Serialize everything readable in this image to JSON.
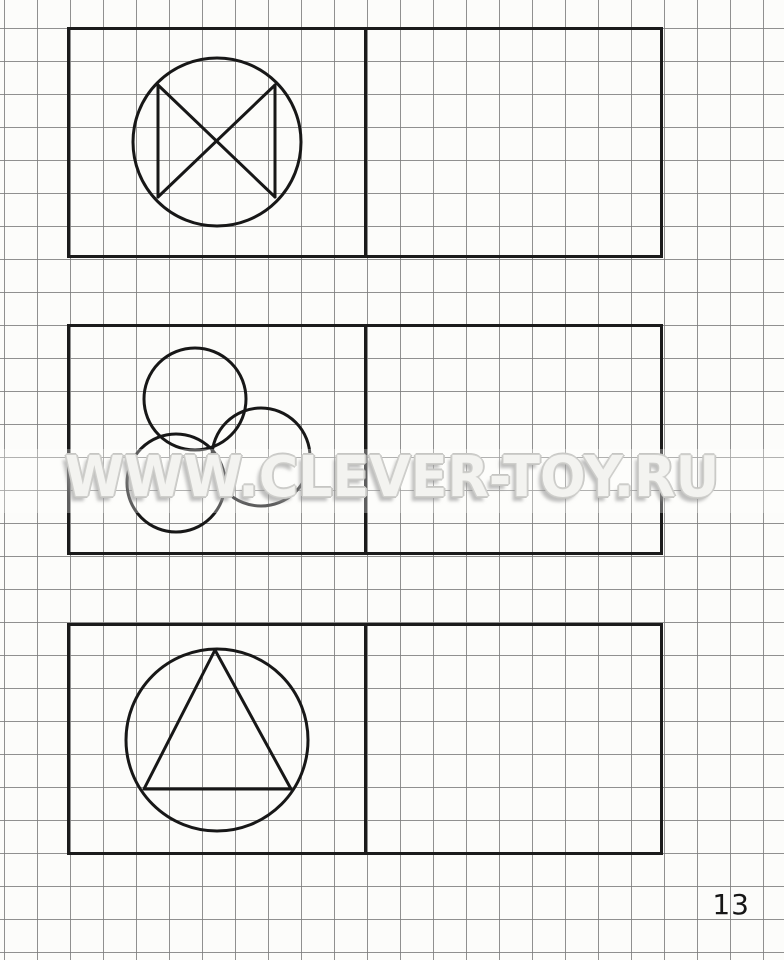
{
  "page": {
    "watermark": "WWW.CLEVER-TOY.RU",
    "page_number": "13"
  },
  "colors": {
    "paper": "#fcfcfa",
    "grid_line": "#7d7d7d",
    "ink": "#171717",
    "watermark_fill": "#f3f3f0",
    "watermark_outline": "#c6c6c3"
  },
  "grid": {
    "cell_px": 33
  },
  "exercises": [
    {
      "name": "circle-with-cross-and-side-chords",
      "sample_side": "left",
      "copy_side": "right",
      "shapes": [
        {
          "type": "circle",
          "cx": 150,
          "cy": 115,
          "r": 84
        },
        {
          "type": "line",
          "x1": 91,
          "y1": 58,
          "x2": 91,
          "y2": 170
        },
        {
          "type": "line",
          "x1": 208,
          "y1": 58,
          "x2": 208,
          "y2": 170
        },
        {
          "type": "line",
          "x1": 91,
          "y1": 58,
          "x2": 208,
          "y2": 170
        },
        {
          "type": "line",
          "x1": 208,
          "y1": 58,
          "x2": 91,
          "y2": 170
        }
      ]
    },
    {
      "name": "three-overlapping-circles",
      "sample_side": "left",
      "copy_side": "right",
      "shapes": [
        {
          "type": "circle",
          "cx": 128,
          "cy": 75,
          "r": 51
        },
        {
          "type": "circle",
          "cx": 194,
          "cy": 133,
          "r": 49
        },
        {
          "type": "circle",
          "cx": 109,
          "cy": 159,
          "r": 49
        }
      ]
    },
    {
      "name": "circle-with-inscribed-triangle",
      "sample_side": "left",
      "copy_side": "right",
      "shapes": [
        {
          "type": "circle",
          "cx": 150,
          "cy": 117,
          "r": 91
        },
        {
          "type": "polygon",
          "points": "148,27 77,166 224,166"
        }
      ]
    }
  ]
}
